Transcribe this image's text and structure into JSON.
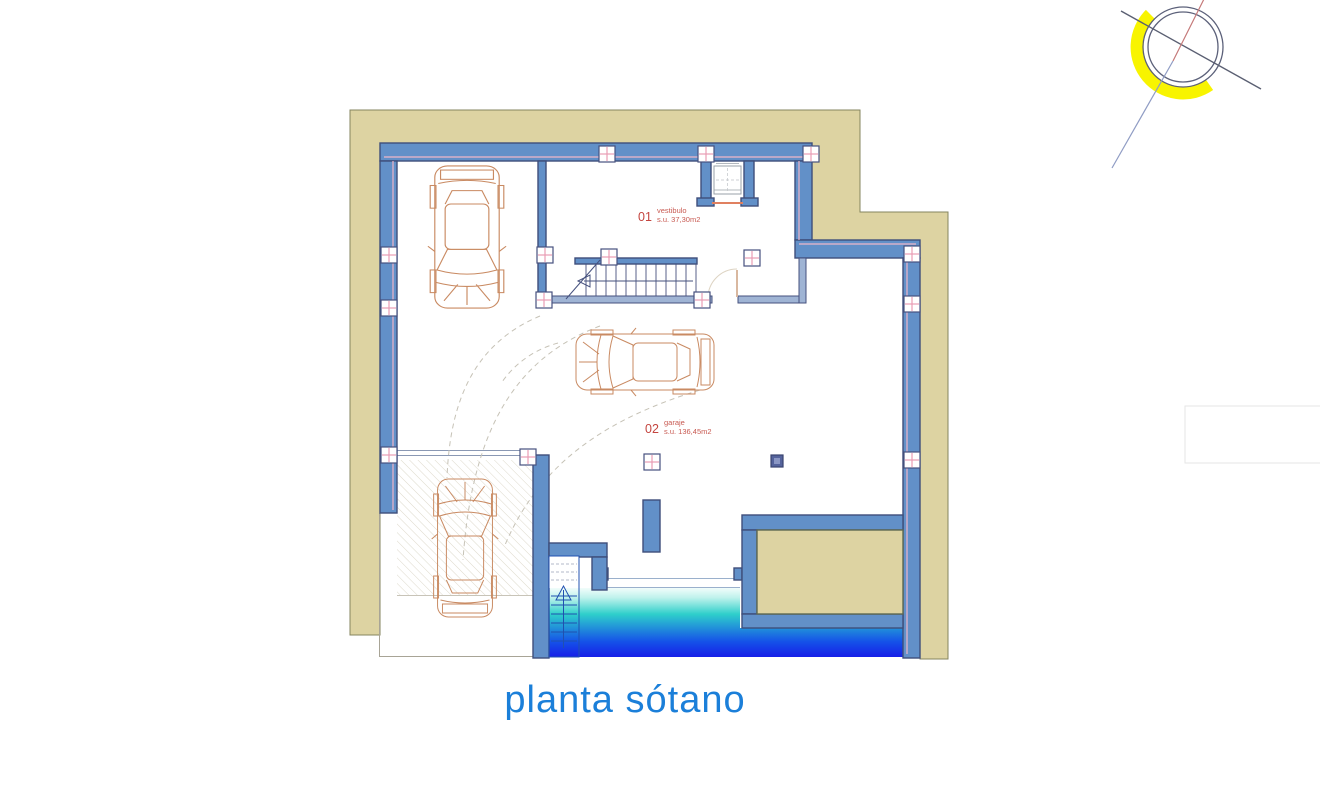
{
  "title": "planta sótano",
  "drawing": {
    "type": "architectural-floor-plan",
    "level": "basement",
    "rooms": [
      {
        "number": "01",
        "name": "vestibulo",
        "area": "s.u. 37,30m2"
      },
      {
        "number": "02",
        "name": "garaje",
        "area": "s.u. 136,45m2"
      }
    ],
    "features": [
      "staircase",
      "elevator",
      "pool",
      "ramp",
      "three-cars",
      "north-compass"
    ]
  },
  "colors": {
    "wall_fill": "#6290c8",
    "wall_outline": "#3f4e7a",
    "site_band_tan": "#ddd3a2",
    "pillar_pink": "#e89cb4",
    "car_outline": "#c98a62",
    "pool_deep_blue": "#161fe8",
    "pool_turquoise": "#2ecfcb",
    "title_blue": "#1b7fd9",
    "label_red": "#c4453f",
    "compass_yellow": "#f8f400"
  }
}
